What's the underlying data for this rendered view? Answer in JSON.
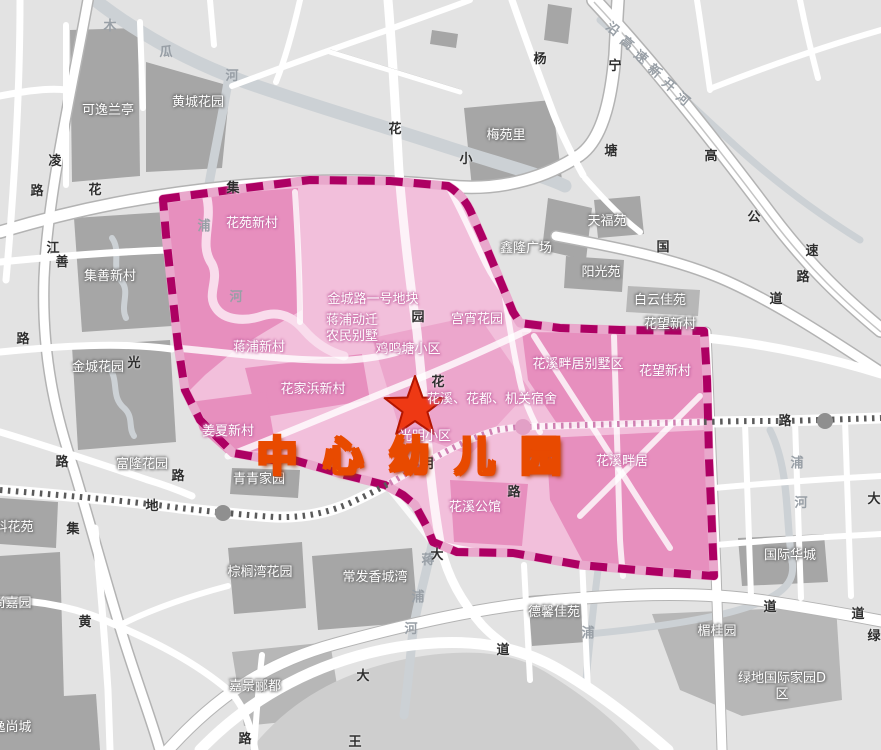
{
  "map": {
    "title": {
      "text": "中 心 幼 儿 园",
      "x": 412,
      "y": 453
    },
    "star": {
      "x": 415,
      "y": 406
    },
    "colors": {
      "title_color": "#ffd800",
      "title_outline": "#e84a00",
      "boundary": "#ad0063",
      "boundary_light": "#e9a8cc",
      "pink_base": "#f2bfdb",
      "pink_dark": "#e78fbe",
      "pink_med": "#eca6cc",
      "pink_river": "#f9dcec",
      "star_fill": "#ee3914",
      "star_stroke": "#b21500"
    },
    "labels_gray": [
      {
        "t": "可逸兰亭",
        "x": 108,
        "y": 111
      },
      {
        "t": "黄城花园",
        "x": 198,
        "y": 103
      },
      {
        "t": "梅苑里",
        "x": 506,
        "y": 136
      },
      {
        "t": "天福苑",
        "x": 607,
        "y": 222
      },
      {
        "t": "鑫隆广场",
        "x": 526,
        "y": 249
      },
      {
        "t": "阳光苑",
        "x": 601,
        "y": 273
      },
      {
        "t": "白云佳苑",
        "x": 660,
        "y": 301
      },
      {
        "t": "花望新村",
        "x": 670,
        "y": 325
      },
      {
        "t": "集善新村",
        "x": 110,
        "y": 277
      },
      {
        "t": "金城花园",
        "x": 98,
        "y": 368
      },
      {
        "t": "富隆花园",
        "x": 142,
        "y": 465
      },
      {
        "t": "青青家园",
        "x": 259,
        "y": 480
      },
      {
        "t": "科花苑",
        "x": 14,
        "y": 528
      },
      {
        "t": "尚嘉园",
        "x": 12,
        "y": 604
      },
      {
        "t": "逸尚城",
        "x": 12,
        "y": 728
      },
      {
        "t": "棕榈湾花园",
        "x": 260,
        "y": 573
      },
      {
        "t": "嘉景郦都",
        "x": 255,
        "y": 687
      },
      {
        "t": "常发香城湾",
        "x": 375,
        "y": 578
      },
      {
        "t": "德馨佳苑",
        "x": 554,
        "y": 613
      },
      {
        "t": "国际华城",
        "x": 790,
        "y": 556
      },
      {
        "t": "楣桂园",
        "x": 717,
        "y": 632
      },
      {
        "t": "绿地国际家园D区",
        "x": 782,
        "y": 687
      }
    ],
    "labels_pink": [
      {
        "t": "花苑新村",
        "x": 252,
        "y": 224
      },
      {
        "t": "蒋浦新村",
        "x": 259,
        "y": 348
      },
      {
        "t": "金城路一号地块",
        "x": 373,
        "y": 300
      },
      {
        "t": "蒋浦动迁\n农民别墅",
        "x": 352,
        "y": 329
      },
      {
        "t": "鸡鸣塘小区",
        "x": 408,
        "y": 350
      },
      {
        "t": "宫宵花园",
        "x": 477,
        "y": 320
      },
      {
        "t": "花家浜新村",
        "x": 313,
        "y": 390
      },
      {
        "t": "姜夏新村",
        "x": 228,
        "y": 432
      },
      {
        "t": "花溪、花都、机关宿舍",
        "x": 492,
        "y": 400
      },
      {
        "t": "光明小区",
        "x": 425,
        "y": 437
      },
      {
        "t": "花溪公馆",
        "x": 475,
        "y": 508
      },
      {
        "t": "花溪畔居别墅区",
        "x": 578,
        "y": 365
      },
      {
        "t": "花望新村",
        "x": 665,
        "y": 372
      },
      {
        "t": "花溪畔居",
        "x": 622,
        "y": 462
      }
    ],
    "road_chars": [
      {
        "t": "凌",
        "x": 55,
        "y": 162
      },
      {
        "t": "路",
        "x": 37,
        "y": 192
      },
      {
        "t": "路",
        "x": 23,
        "y": 340
      },
      {
        "t": "花",
        "x": 95,
        "y": 191
      },
      {
        "t": "集",
        "x": 233,
        "y": 189
      },
      {
        "t": "花",
        "x": 395,
        "y": 130
      },
      {
        "t": "江",
        "x": 53,
        "y": 249
      },
      {
        "t": "善",
        "x": 62,
        "y": 263
      },
      {
        "t": "光",
        "x": 134,
        "y": 364
      },
      {
        "t": "路",
        "x": 62,
        "y": 463
      },
      {
        "t": "路",
        "x": 178,
        "y": 477
      },
      {
        "t": "地",
        "x": 152,
        "y": 507
      },
      {
        "t": "集",
        "x": 73,
        "y": 530
      },
      {
        "t": "黄",
        "x": 85,
        "y": 623
      },
      {
        "t": "路",
        "x": 245,
        "y": 740
      },
      {
        "t": "王",
        "x": 355,
        "y": 743
      },
      {
        "t": "小",
        "x": 466,
        "y": 160
      },
      {
        "t": "杨",
        "x": 540,
        "y": 60
      },
      {
        "t": "宁",
        "x": 615,
        "y": 67
      },
      {
        "t": "塘",
        "x": 611,
        "y": 152
      },
      {
        "t": "高",
        "x": 711,
        "y": 157
      },
      {
        "t": "公",
        "x": 754,
        "y": 218
      },
      {
        "t": "速",
        "x": 812,
        "y": 252
      },
      {
        "t": "路",
        "x": 803,
        "y": 278
      },
      {
        "t": "国",
        "x": 663,
        "y": 248
      },
      {
        "t": "道",
        "x": 776,
        "y": 300
      },
      {
        "t": "园",
        "x": 418,
        "y": 318
      },
      {
        "t": "花",
        "x": 438,
        "y": 383
      },
      {
        "t": "明",
        "x": 427,
        "y": 465
      },
      {
        "t": "路",
        "x": 514,
        "y": 493
      },
      {
        "t": "路",
        "x": 785,
        "y": 422
      },
      {
        "t": "大",
        "x": 437,
        "y": 556
      },
      {
        "t": "道",
        "x": 503,
        "y": 651
      },
      {
        "t": "大",
        "x": 363,
        "y": 677
      },
      {
        "t": "道",
        "x": 770,
        "y": 608
      },
      {
        "t": "道",
        "x": 858,
        "y": 615
      },
      {
        "t": "大",
        "x": 874,
        "y": 500
      },
      {
        "t": "绿",
        "x": 874,
        "y": 637
      }
    ],
    "river_chars": [
      {
        "t": "木",
        "x": 110,
        "y": 27
      },
      {
        "t": "瓜",
        "x": 166,
        "y": 53
      },
      {
        "t": "河",
        "x": 232,
        "y": 77
      },
      {
        "t": "浦",
        "x": 204,
        "y": 227
      },
      {
        "t": "河",
        "x": 236,
        "y": 298
      },
      {
        "t": "蒋",
        "x": 428,
        "y": 561
      },
      {
        "t": "浦",
        "x": 418,
        "y": 598
      },
      {
        "t": "河",
        "x": 411,
        "y": 630
      },
      {
        "t": "浦",
        "x": 797,
        "y": 464
      },
      {
        "t": "河",
        "x": 801,
        "y": 504
      },
      {
        "t": "浦",
        "x": 588,
        "y": 634
      },
      {
        "t": "沿",
        "x": 612,
        "y": 30,
        "r": 40
      },
      {
        "t": "高",
        "x": 626,
        "y": 44,
        "r": 40
      },
      {
        "t": "速",
        "x": 640,
        "y": 58,
        "r": 40
      },
      {
        "t": "新",
        "x": 654,
        "y": 72,
        "r": 40
      },
      {
        "t": "开",
        "x": 668,
        "y": 86,
        "r": 40
      },
      {
        "t": "河",
        "x": 682,
        "y": 100,
        "r": 40
      }
    ]
  }
}
